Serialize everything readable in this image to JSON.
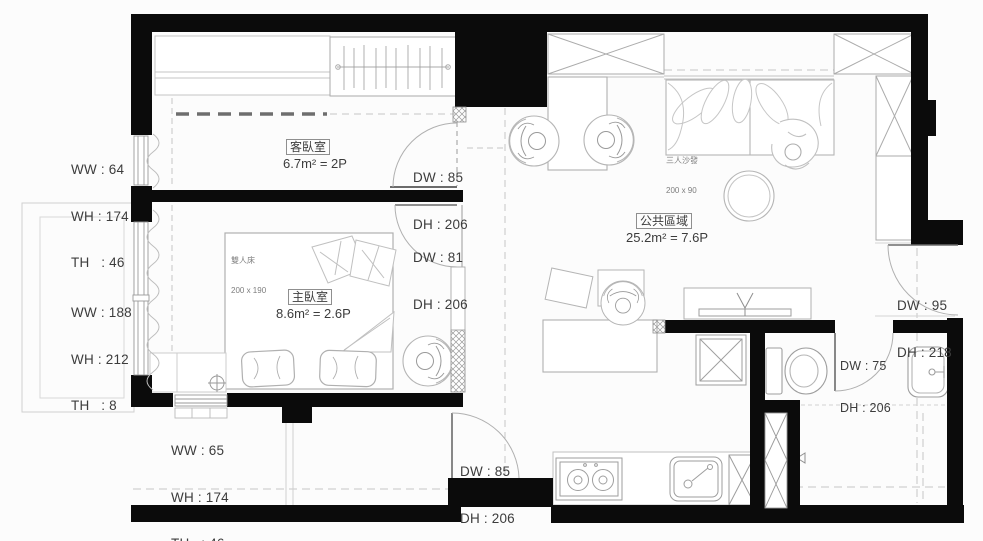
{
  "rooms": {
    "guest_bedroom": {
      "name": "客臥室",
      "area": "6.7m² = 2P"
    },
    "master_bedroom": {
      "name": "主臥室",
      "area": "8.6m² = 2.6P"
    },
    "public_area": {
      "name": "公共區域",
      "area": "25.2m² = 7.6P"
    }
  },
  "furniture": {
    "double_bed": {
      "name": "雙人床",
      "size": "200 x 190"
    },
    "sofa": {
      "name": "三人沙發",
      "size": "200 x 90"
    }
  },
  "windows": {
    "guest_left": {
      "l1": "WW : 64",
      "l2": "WH : 174",
      "l3": "TH   : 46"
    },
    "master_left": {
      "l1": "WW : 188",
      "l2": "WH : 212",
      "l3": "TH   : 8"
    },
    "master_bottom": {
      "l1": "WW : 65",
      "l2": "WH : 174",
      "l3": "TH   : 46"
    }
  },
  "doors": {
    "guest": {
      "l1": "DW : 85",
      "l2": "DH : 206"
    },
    "master": {
      "l1": "DW : 81",
      "l2": "DH : 206"
    },
    "entry_right": {
      "l1": "DW : 95",
      "l2": "DH : 218"
    },
    "bathroom": {
      "l1": "DW : 75",
      "l2": "DH : 206"
    },
    "entry_bottom": {
      "l1": "DW : 85",
      "l2": "DH : 206"
    }
  },
  "colors": {
    "wall": "#0b0b0b",
    "furniture_line": "#b8b8b8",
    "fixture_line": "#9e9e9e"
  }
}
